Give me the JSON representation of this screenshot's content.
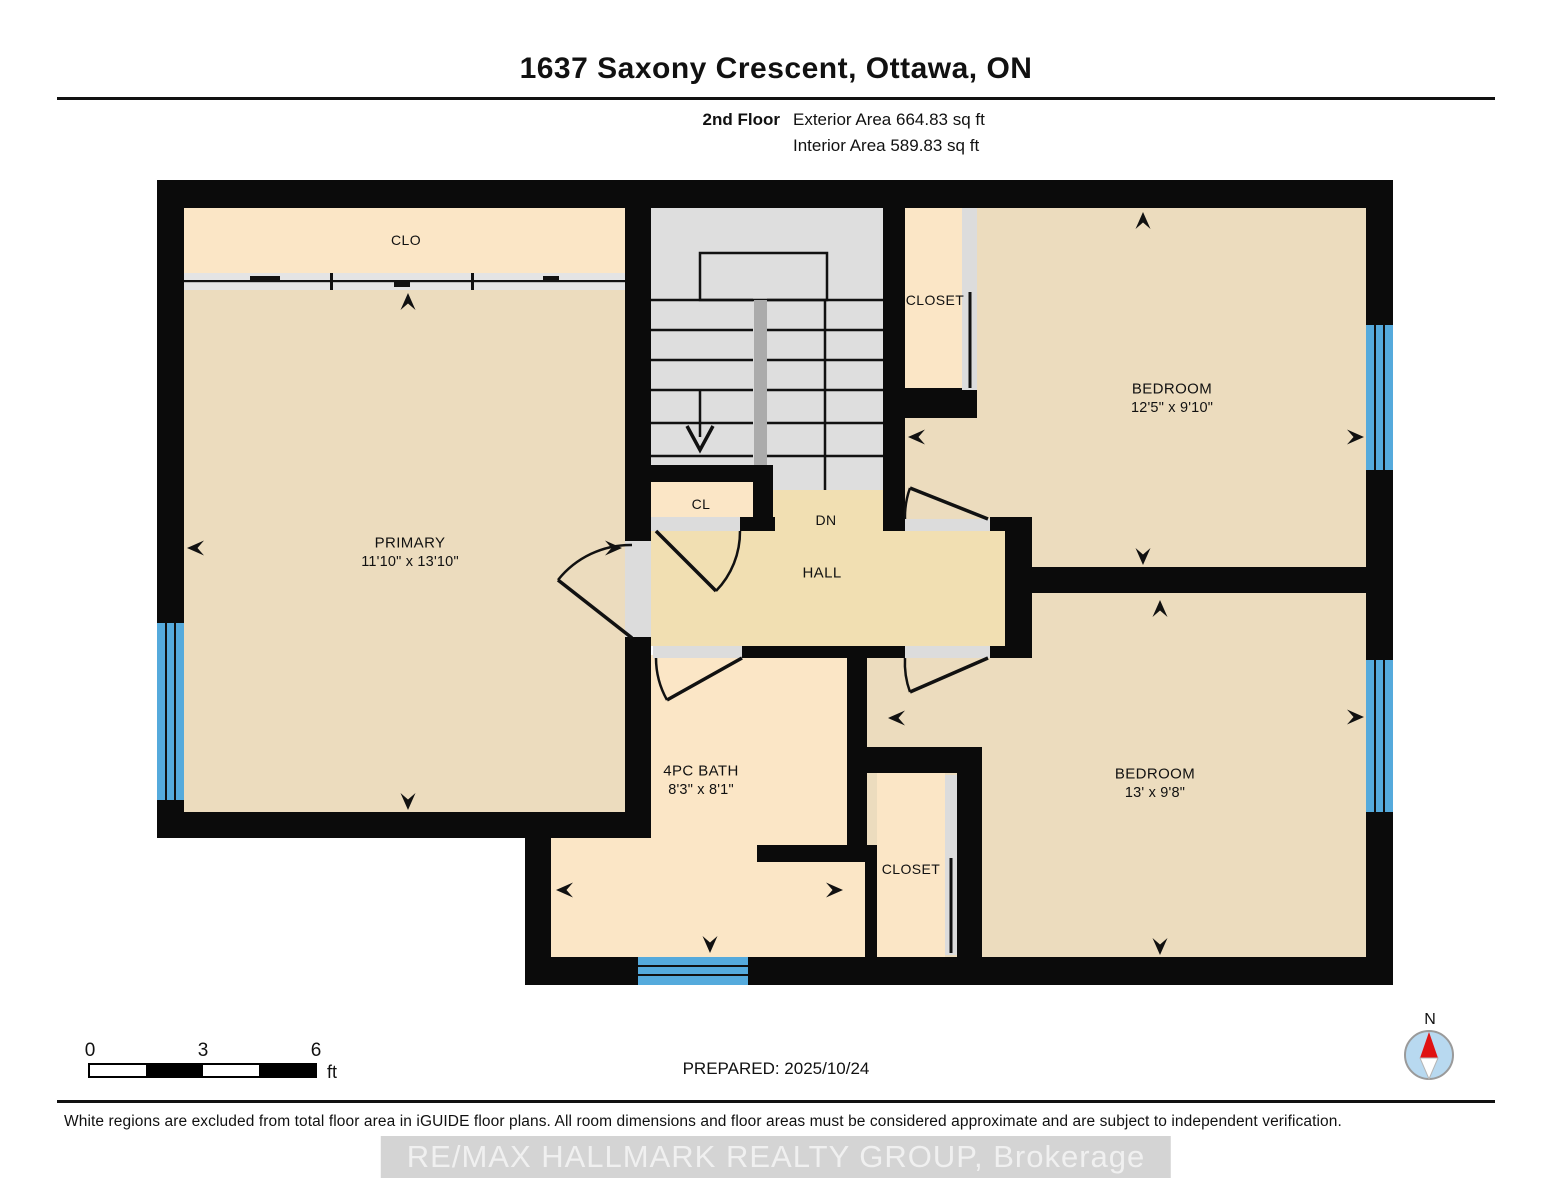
{
  "header": {
    "title": "1637 Saxony Crescent, Ottawa, ON",
    "floor_label": "2nd Floor",
    "exterior_area": "Exterior Area 664.83 sq ft",
    "interior_area": "Interior Area 589.83 sq ft"
  },
  "plan": {
    "clo": {
      "label": "CLO"
    },
    "primary": {
      "label": "PRIMARY",
      "dims": "11'10\" x 13'10\""
    },
    "cl": {
      "label": "CL"
    },
    "stairs": {
      "down_label": "DN"
    },
    "hall": {
      "label": "HALL"
    },
    "closet_top": {
      "label": "CLOSET"
    },
    "bedroom_top": {
      "label": "BEDROOM",
      "dims": "12'5\" x 9'10\""
    },
    "bath": {
      "label": "4PC BATH",
      "dims": "8'3\" x 8'1\""
    },
    "closet_bottom": {
      "label": "CLOSET"
    },
    "bedroom_bottom": {
      "label": "BEDROOM",
      "dims": "13' x 9'8\""
    }
  },
  "scale_bar": {
    "start": "0",
    "mid": "3",
    "end": "6",
    "unit": "ft"
  },
  "compass": {
    "north_label": "N"
  },
  "footer": {
    "prepared": "PREPARED: 2025/10/24",
    "disclaimer": "White regions are excluded from total floor area in iGUIDE floor plans. All room dimensions and floor areas must be considered approximate and are subject to independent verification.",
    "watermark": "RE/MAX HALLMARK REALTY GROUP, Brokerage"
  },
  "colors": {
    "wall": "#0b0b0b",
    "room": "#ecdcbe",
    "closet": "#fbe6c6",
    "hall": "#f1dfb2",
    "stairs": "#dedede",
    "stair-divider": "#ababab",
    "threshold": "#dcdcdc",
    "window": "#55aadc",
    "compass-fill": "#b8d9f0",
    "compass-north": "#e01212",
    "watermark-bg": "#d4d4d4",
    "watermark-text": "#f0f0f0"
  }
}
